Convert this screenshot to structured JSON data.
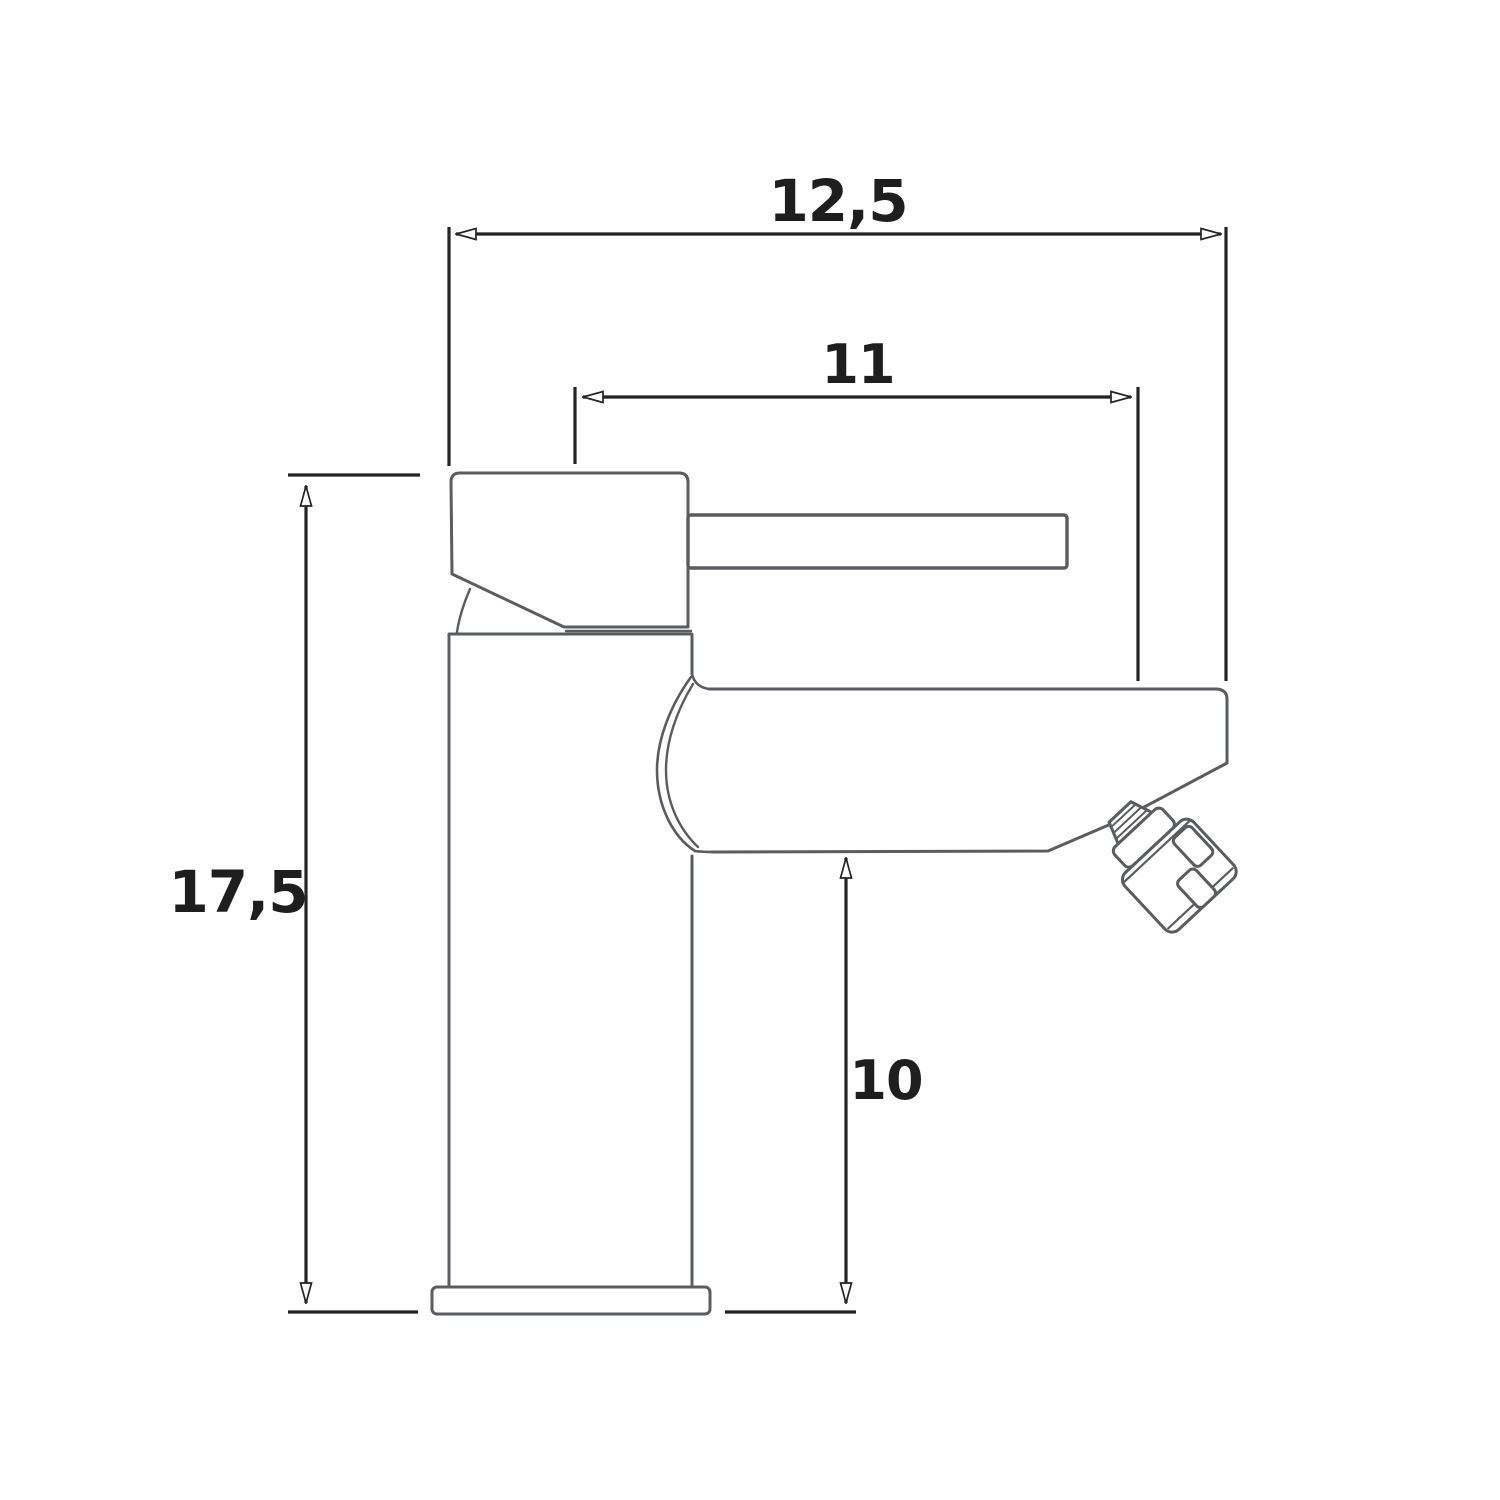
{
  "drawing": {
    "kind": "technical-dimension-drawing",
    "subject": "single-lever mixer tap, side elevation",
    "background_color": "#ffffff",
    "outline_color": "#5b5c5f",
    "dimension_line_color": "#242424",
    "text_color": "#1e1e1f",
    "dimensions": {
      "overall_width": "12,5",
      "spout_width": "11",
      "overall_height": "17,5",
      "spout_height": "10"
    }
  }
}
